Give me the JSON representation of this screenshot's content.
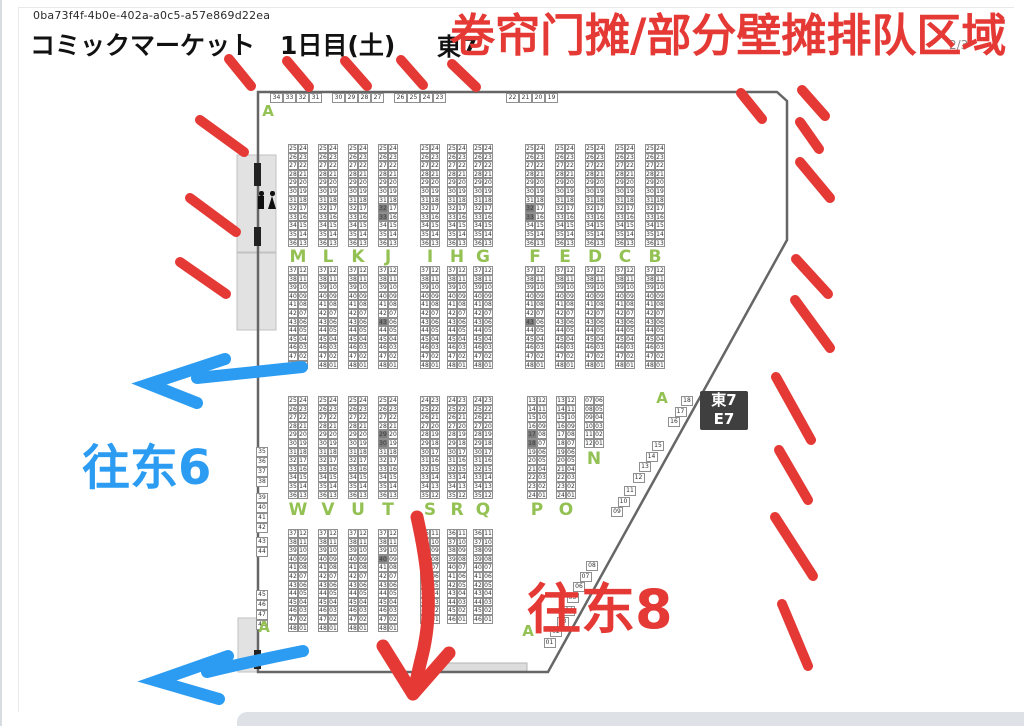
{
  "page": {
    "uuid": "0ba73f4f-4b0e-402a-a0c5-a57e869d22ea",
    "title": "コミックマーケット　1日目(土)",
    "hall_heading": "東7",
    "page_indicator": "2/3"
  },
  "annotations": {
    "red_title": "卷帘门摊/部分壁摊排队区域",
    "to_east6": "往东6",
    "to_east8": "往东8"
  },
  "hall_box": {
    "line1": "東7",
    "line2": "E7"
  },
  "colors": {
    "annotation_red": "#e53935",
    "annotation_blue": "#2b9cf2",
    "row_letter_green": "#93c153",
    "wall_gray": "#666666",
    "hall_box_bg": "#3f3f3f",
    "dark_cell_gray": "#7d7d7d"
  },
  "map": {
    "row_h": 8.6,
    "cell_w": 10,
    "strips": [
      {
        "y": 144,
        "rows": 12,
        "left_start": 25,
        "right_start": 24,
        "cols": [
          {
            "x": 288
          },
          {
            "x": 318
          },
          {
            "x": 348
          },
          {
            "x": 378,
            "dark": [
              32,
              33
            ]
          },
          {
            "x": 420
          },
          {
            "x": 447
          },
          {
            "x": 473
          },
          {
            "x": 525,
            "dark": [
              32,
              33
            ]
          },
          {
            "x": 555
          },
          {
            "x": 585
          },
          {
            "x": 615
          },
          {
            "x": 645
          }
        ]
      },
      {
        "y": 266,
        "rows": 12,
        "left_start": 37,
        "right_start": 12,
        "cols": [
          {
            "x": 288
          },
          {
            "x": 318
          },
          {
            "x": 348
          },
          {
            "x": 378,
            "dark": [
              43
            ]
          },
          {
            "x": 420
          },
          {
            "x": 447
          },
          {
            "x": 473
          },
          {
            "x": 525,
            "dark": [
              43
            ]
          },
          {
            "x": 555
          },
          {
            "x": 585
          },
          {
            "x": 615
          },
          {
            "x": 645
          }
        ]
      },
      {
        "y": 396,
        "rows": 12,
        "left_start": 25,
        "right_start": 24,
        "cols": [
          {
            "x": 288
          },
          {
            "x": 318
          },
          {
            "x": 348
          },
          {
            "x": 378,
            "dark": [
              29,
              30
            ]
          }
        ]
      },
      {
        "y": 396,
        "rows": 12,
        "left_start": 24,
        "right_start": 23,
        "cols": [
          {
            "x": 420
          },
          {
            "x": 447
          },
          {
            "x": 473
          }
        ]
      },
      {
        "y": 396,
        "rows": 12,
        "left_start": 13,
        "right_start": 12,
        "cols": [
          {
            "x": 527,
            "dark": [
              17,
              18
            ]
          },
          {
            "x": 556
          }
        ]
      },
      {
        "y": 396,
        "rows": 6,
        "left_start": 7,
        "right_start": 6,
        "cols": [
          {
            "x": 584
          }
        ]
      },
      {
        "y": 529,
        "rows": 12,
        "left_start": 37,
        "right_start": 12,
        "cols": [
          {
            "x": 288
          },
          {
            "x": 318
          },
          {
            "x": 348
          },
          {
            "x": 378,
            "dark": [
              40
            ]
          }
        ]
      },
      {
        "y": 529,
        "rows": 11,
        "left_start": 36,
        "right_start": 11,
        "cols": [
          {
            "x": 420
          },
          {
            "x": 447
          },
          {
            "x": 473
          }
        ]
      }
    ],
    "letters": [
      {
        "t": "M",
        "x": 288,
        "y": 247
      },
      {
        "t": "L",
        "x": 318,
        "y": 247
      },
      {
        "t": "K",
        "x": 348,
        "y": 247
      },
      {
        "t": "J",
        "x": 378,
        "y": 247
      },
      {
        "t": "I",
        "x": 420,
        "y": 247
      },
      {
        "t": "H",
        "x": 447,
        "y": 247
      },
      {
        "t": "G",
        "x": 473,
        "y": 247
      },
      {
        "t": "F",
        "x": 525,
        "y": 247
      },
      {
        "t": "E",
        "x": 555,
        "y": 247
      },
      {
        "t": "D",
        "x": 585,
        "y": 247
      },
      {
        "t": "C",
        "x": 615,
        "y": 247
      },
      {
        "t": "B",
        "x": 645,
        "y": 247
      },
      {
        "t": "W",
        "x": 288,
        "y": 500
      },
      {
        "t": "V",
        "x": 318,
        "y": 500
      },
      {
        "t": "U",
        "x": 348,
        "y": 500
      },
      {
        "t": "T",
        "x": 378,
        "y": 500
      },
      {
        "t": "S",
        "x": 420,
        "y": 500
      },
      {
        "t": "R",
        "x": 447,
        "y": 500
      },
      {
        "t": "Q",
        "x": 473,
        "y": 500
      },
      {
        "t": "P",
        "x": 527,
        "y": 500
      },
      {
        "t": "O",
        "x": 556,
        "y": 500
      },
      {
        "t": "N",
        "x": 584,
        "y": 449
      }
    ],
    "a_labels": [
      {
        "t": "A",
        "x": 258,
        "y": 102
      },
      {
        "t": "A",
        "x": 652,
        "y": 389
      },
      {
        "t": "A",
        "x": 254,
        "y": 618
      },
      {
        "t": "A",
        "x": 518,
        "y": 622
      }
    ],
    "wall_top_groups": [
      {
        "x": 270,
        "y": 93,
        "nums": [
          "34",
          "33",
          "32",
          "31"
        ]
      },
      {
        "x": 332,
        "y": 93,
        "nums": [
          "30",
          "29",
          "28",
          "27"
        ]
      },
      {
        "x": 394,
        "y": 93,
        "nums": [
          "26",
          "25",
          "24",
          "23"
        ]
      },
      {
        "x": 506,
        "y": 93,
        "nums": [
          "22",
          "21",
          "20",
          "19"
        ]
      }
    ],
    "wall_left_groups": [
      {
        "x": 256,
        "y": 447,
        "nums": [
          "35",
          "36",
          "37",
          "38"
        ]
      },
      {
        "x": 256,
        "y": 493,
        "nums": [
          "39",
          "40",
          "41",
          "42"
        ]
      },
      {
        "x": 256,
        "y": 537,
        "nums": [
          "43",
          "44"
        ]
      },
      {
        "x": 256,
        "y": 590,
        "nums": [
          "45",
          "46",
          "47",
          "48"
        ]
      }
    ],
    "diag_step": {
      "dx": -6.5,
      "dy": 10.5
    },
    "diag_groups": [
      {
        "x": 681,
        "y": 396,
        "nums": [
          "18",
          "17",
          "16"
        ]
      },
      {
        "x": 652,
        "y": 441,
        "nums": [
          "15",
          "14",
          "13",
          "12"
        ]
      },
      {
        "x": 624,
        "y": 486,
        "nums": [
          "11",
          "10",
          "09"
        ]
      },
      {
        "x": 586,
        "y": 561,
        "nums": [
          "08",
          "07",
          "06",
          "05"
        ]
      },
      {
        "x": 563,
        "y": 606,
        "nums": [
          "04",
          "03",
          "02",
          "01"
        ]
      }
    ]
  }
}
